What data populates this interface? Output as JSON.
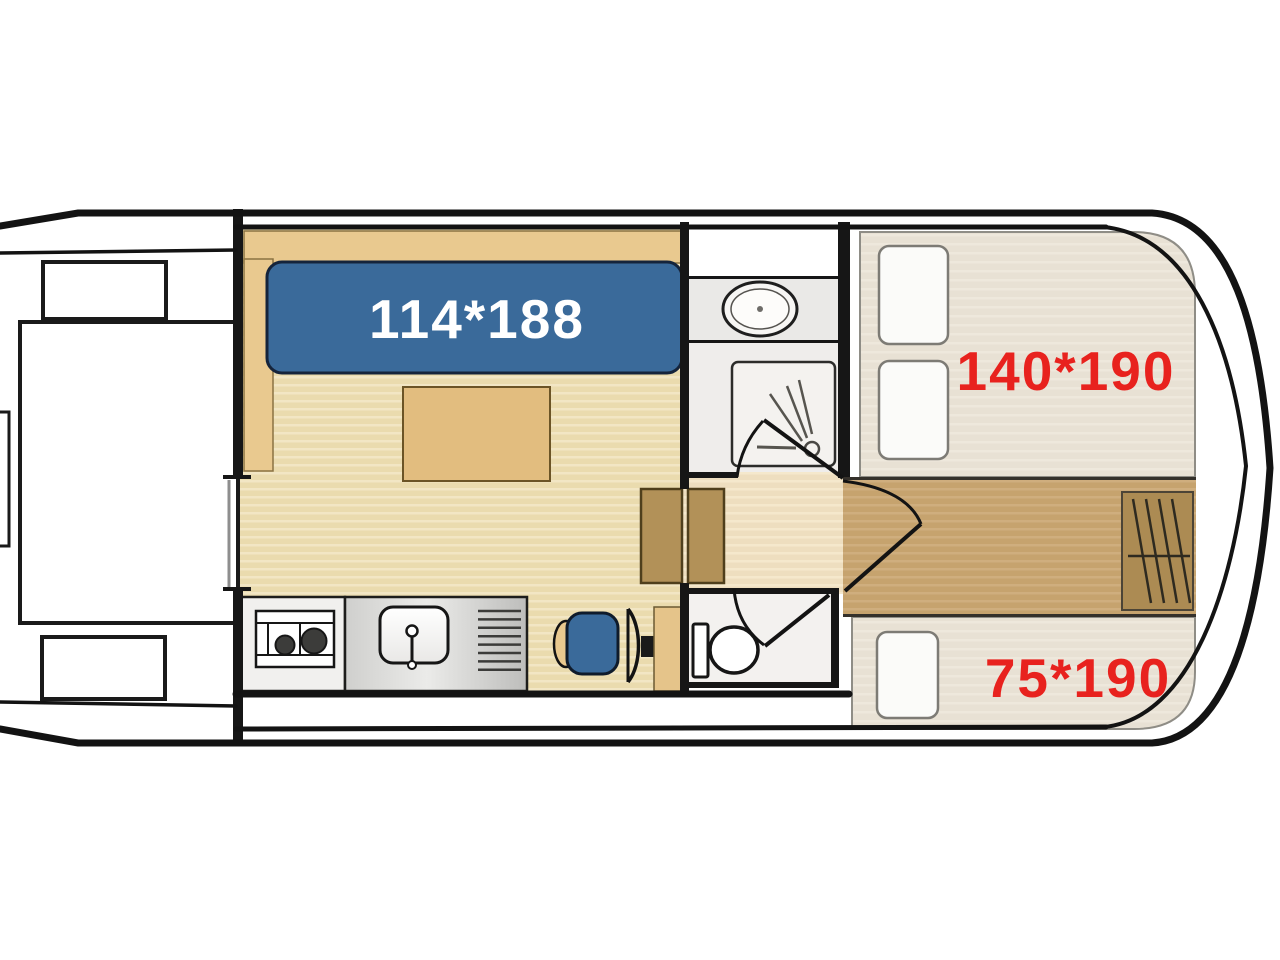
{
  "diagram": {
    "type": "houseboat floor plan, top view",
    "labels": {
      "saloon_berth": "114*188",
      "bow_double_berth": "140*190",
      "bow_single_berth": "75*190"
    },
    "colors": {
      "hull_outline": "#141414",
      "floor_wood": "#eadbae",
      "floor_stripe": "#f2e6c4",
      "corridor_light": "#eedebf",
      "corridor_dark": "#c6a36e",
      "bench_wood": "#e9c98f",
      "table_wood": "#e2bd7f",
      "cabinet_wood": "#b29158",
      "stair_hatch_wood": "#ac8b53",
      "mattress": "#e8e1d4",
      "pillow": "#fbfbf9",
      "berth_blue": "#3a6a9a",
      "dimension_red": "#e8221e",
      "counter_steel": "#c9c9c7",
      "bathroom_floor": "#efedeb"
    },
    "rooms": [
      {
        "name": "aft deck",
        "furniture": [
          "bench",
          "bench",
          "deck table",
          "stern platform"
        ]
      },
      {
        "name": "saloon",
        "furniture": [
          "L-shaped bench",
          "convertible berth 114*188",
          "table",
          "stove",
          "sink with drainer",
          "helm seat",
          "steering wheel",
          "helm console",
          "cabinet"
        ]
      },
      {
        "name": "bathroom",
        "furniture": [
          "washbasin",
          "shower tray with shower head"
        ]
      },
      {
        "name": "toilet room",
        "furniture": [
          "toilet"
        ]
      },
      {
        "name": "bow cabin",
        "furniture": [
          "double berth 140*190",
          "single berth 75*190",
          "three pillows",
          "companionway steps hatch"
        ]
      }
    ]
  }
}
